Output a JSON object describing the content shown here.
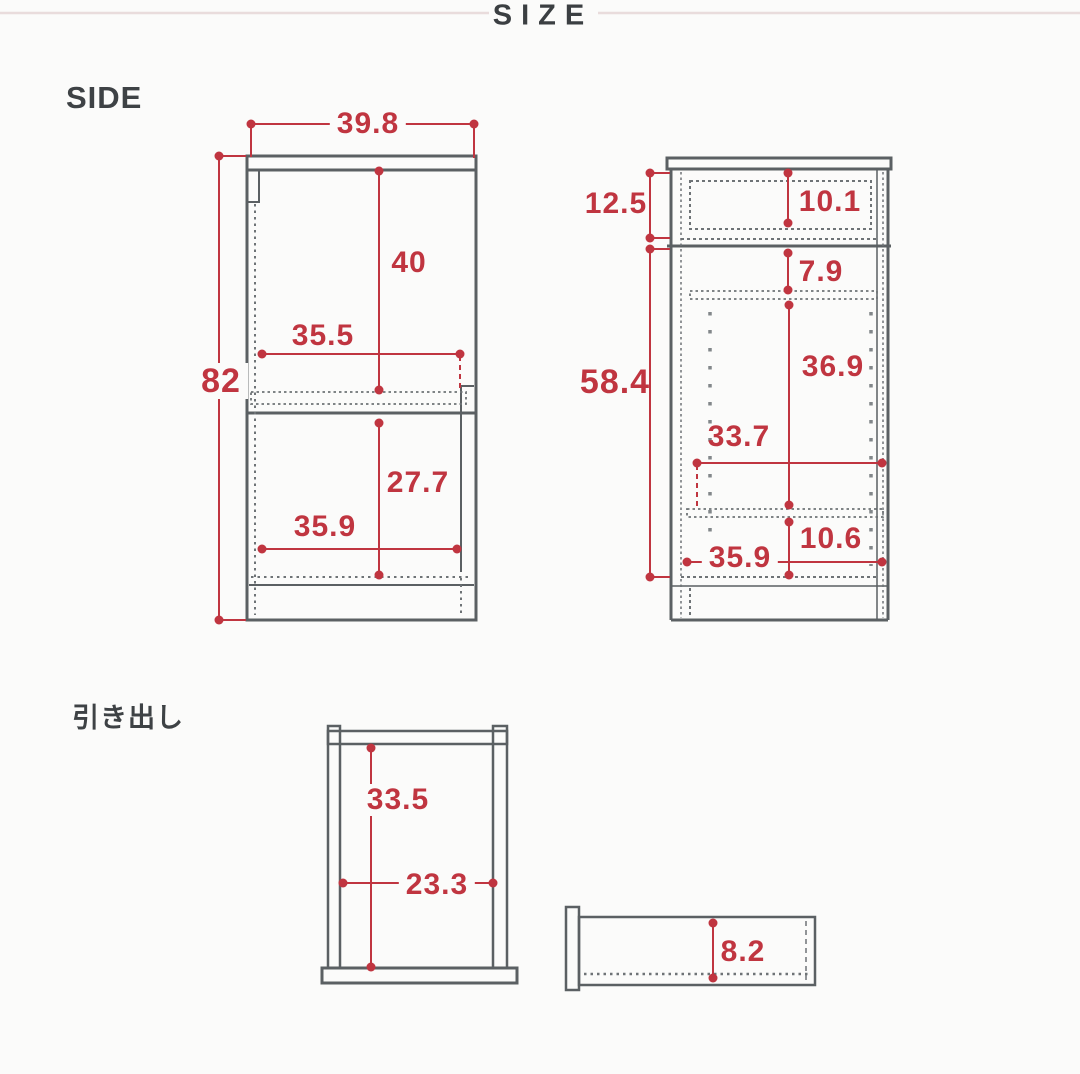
{
  "header": {
    "title": "SIZE"
  },
  "sections": {
    "side": "SIDE",
    "drawer": "引き出し"
  },
  "units_note": "",
  "cabinet_side": {
    "top_width": "39.8",
    "total_height": "82",
    "upper_height": "40",
    "upper_width": "35.5",
    "lower_height": "27.7",
    "lower_width": "35.9"
  },
  "cabinet_front": {
    "drawer_height": "12.5",
    "drawer_inner_height": "10.1",
    "body_height": "58.4",
    "top_clearance": "7.9",
    "shelf_area_height": "36.9",
    "shelf_width": "33.7",
    "bottom_clearance": "10.6",
    "inner_width": "35.9"
  },
  "drawer_top": {
    "inner_depth": "33.5",
    "inner_width": "23.3"
  },
  "drawer_side": {
    "inner_height": "8.2"
  },
  "colors": {
    "dimension_red": "#c03540",
    "outline_grey": "#5b6063",
    "dotted_grey": "#6e7376",
    "peg_grey": "#82878a",
    "header_rule": "#e9dcdc",
    "heading_text": "#3b3f42",
    "background": "#fbfbfa"
  }
}
